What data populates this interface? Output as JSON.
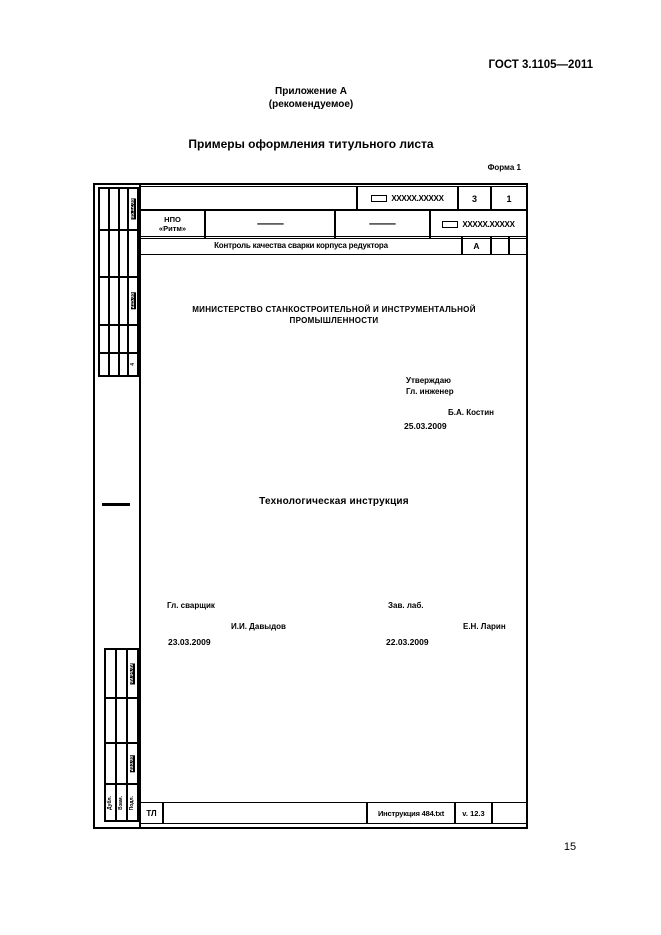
{
  "page": {
    "standard_number": "ГОСТ 3.1105—2011",
    "appendix_title": "Приложение А",
    "appendix_subtitle": "(рекомендуемое)",
    "section_title": "Примеры оформления титульного листа",
    "form_label": "Форма 1",
    "page_number": "15"
  },
  "title_form": {
    "header": {
      "doc_designation_top": "XXXXX.XXXXX",
      "total_sheets": "3",
      "sheet_no": "1",
      "organization_line1": "НПО",
      "organization_line2": "«Ритм»",
      "dash_cell_1": "—",
      "dash_cell_2": "—",
      "doc_designation_right": "XXXXX.XXXXX",
      "doc_title": "Контроль качества сварки корпуса редуктора",
      "litera": "А"
    },
    "body": {
      "ministry_line1": "МИНИСТЕРСТВО СТАНКОСТРОИТЕЛЬНОЙ И ИНСТРУМЕНТАЛЬНОЙ",
      "ministry_line2": "ПРОМЫШЛЕННОСТИ",
      "approve_label": "Утверждаю",
      "approve_role": "Гл. инженер",
      "approve_name": "Б.А. Костин",
      "approve_date": "25.03.2009",
      "doc_type": "Технологическая инструкция",
      "sign_left_role": "Гл. сварщик",
      "sign_left_name": "И.И. Давыдов",
      "sign_left_date": "23.03.2009",
      "sign_right_role": "Зав. лаб.",
      "sign_right_name": "Е.Н. Ларин",
      "sign_right_date": "22.03.2009"
    },
    "footer": {
      "doc_kind": "ТЛ",
      "file_name": "Инструкция 484.txt",
      "version": "v. 12.3"
    },
    "left_margin": {
      "stamp_top": "05.12.08",
      "stamp_middle": "215.08",
      "stamp_small": "4",
      "stamp_lower1": "09.04.09",
      "stamp_lower2": "203.08",
      "label_dubl": "Дубл.",
      "label_vzam": "Взам.",
      "label_podl": "Подл."
    }
  }
}
